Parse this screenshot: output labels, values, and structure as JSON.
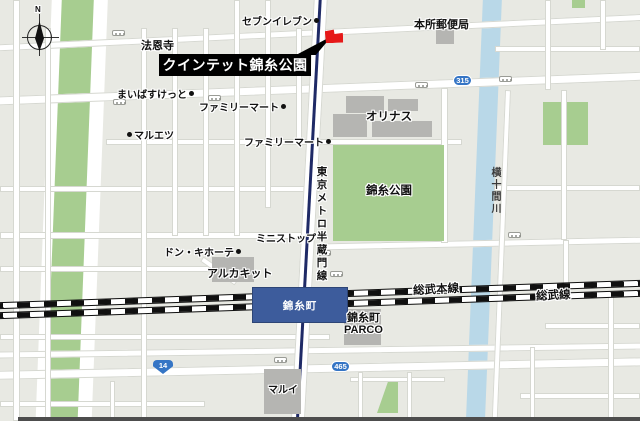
{
  "compass": {
    "north_label": "N"
  },
  "callout": {
    "label": "クインテット錦糸公園"
  },
  "pois": {
    "seven_eleven": "セブンイレブン",
    "honjo_post_office": "本所郵便局",
    "houonji": "法恩寺",
    "maibasuketto": "まいばすけっと",
    "familymart_north": "ファミリーマート",
    "maruetsu": "マルエツ",
    "familymart_east": "ファミリーマート",
    "olinas": "オリナス",
    "kinshi_park": "錦糸公園",
    "ministop": "ミニストップ",
    "don_quijote": "ドン・キホーテ",
    "arcakit": "アルカキット",
    "parco_line1": "錦糸町",
    "parco_line2": "PARCO",
    "marui": "マルイ"
  },
  "station": {
    "name": "錦糸町"
  },
  "railways": {
    "sobu_main": "総武本線",
    "sobu": "総武線",
    "metro": "東京メトロ半蔵門線"
  },
  "river": {
    "name": "横十間川"
  },
  "route_badges": {
    "r315": "315",
    "r14": "14",
    "r465": "465"
  },
  "colors": {
    "marker_red": "#e61919",
    "station_blue": "#3d5c9c",
    "park_green": "#a7cd90",
    "river_blue": "#b9d8e8",
    "badge_blue": "#3575c5",
    "metro_line_navy": "#1f2a66",
    "block_gray": "#e8e9e3"
  }
}
